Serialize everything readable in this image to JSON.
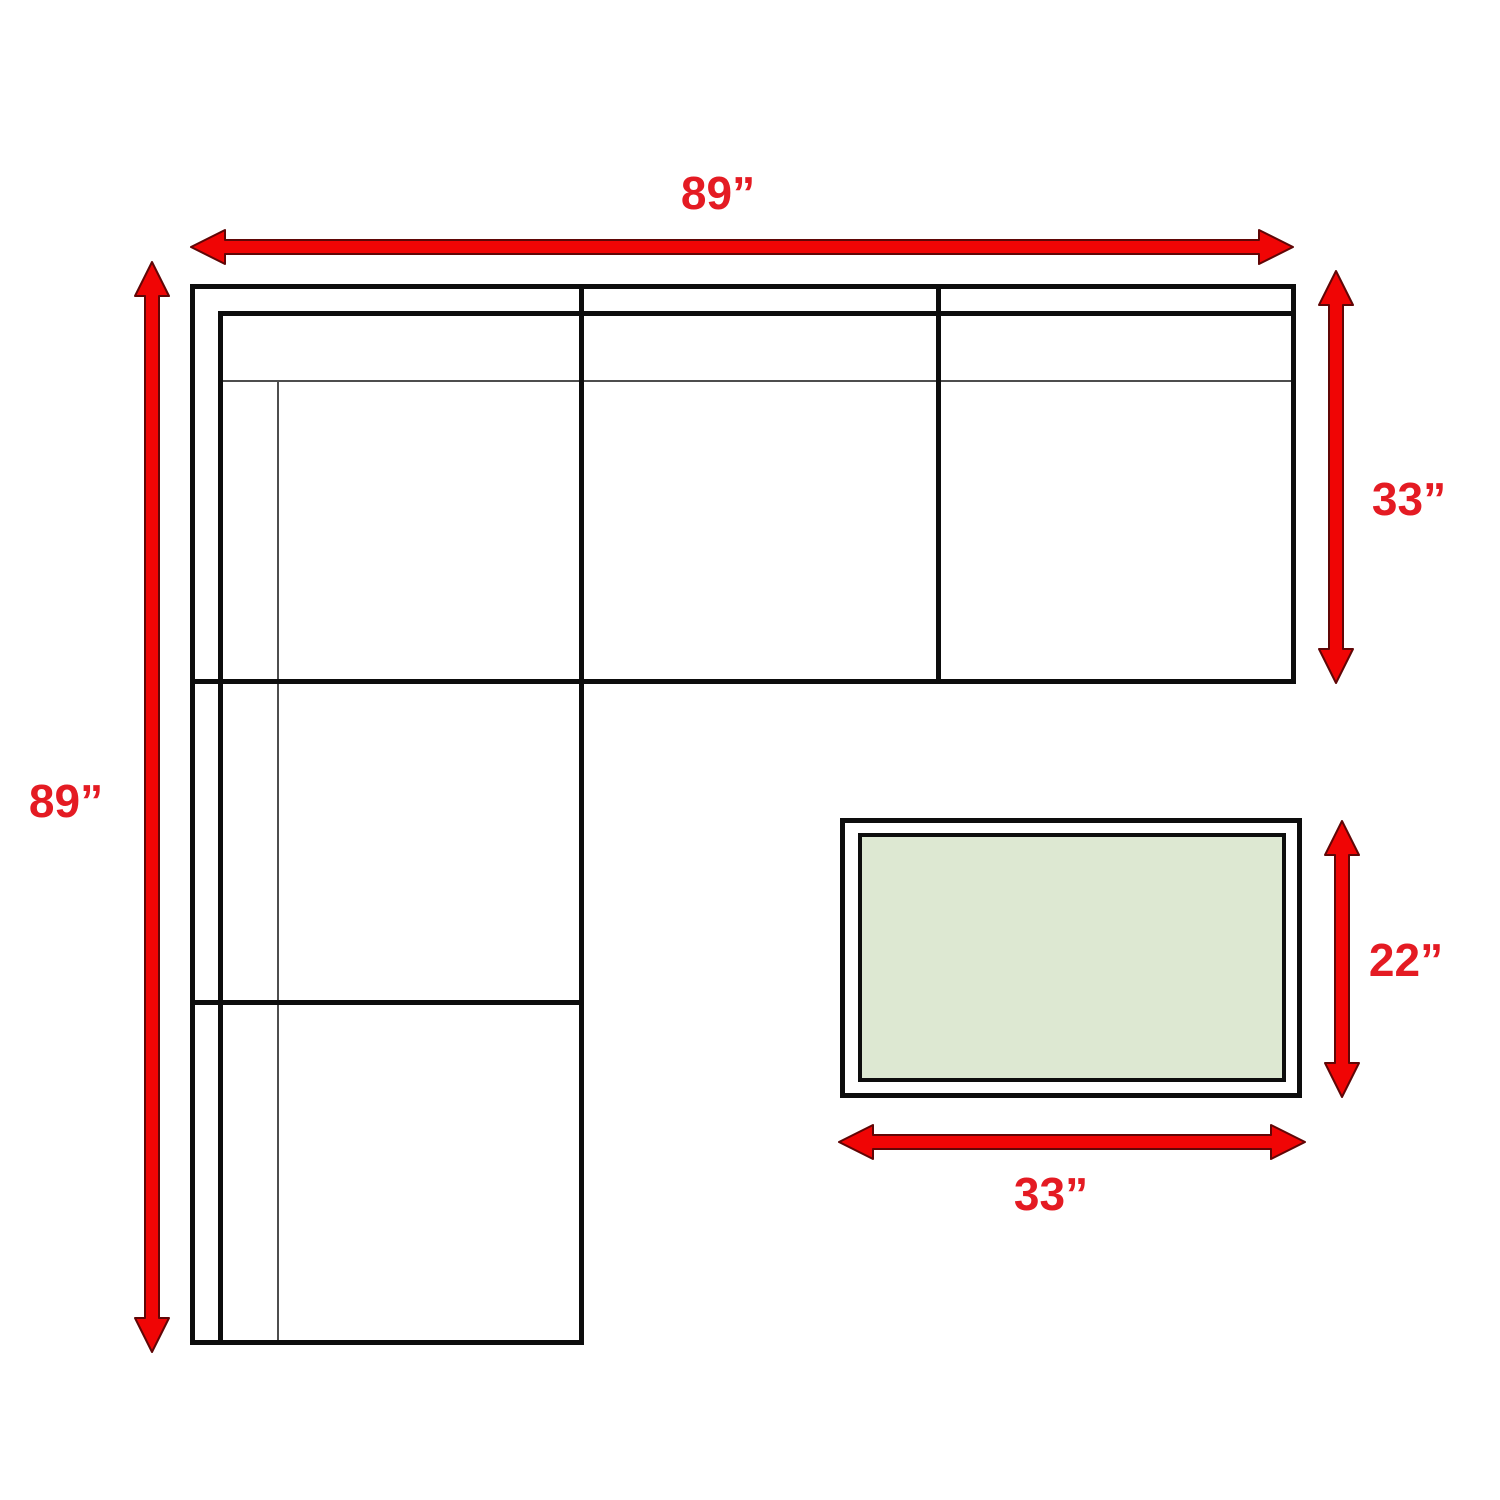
{
  "diagram": {
    "labels": {
      "sofa_width_top": "89”",
      "sofa_length_left": "89”",
      "sofa_depth_right": "33”",
      "table_depth_right": "22”",
      "table_width_bottom": "33”"
    },
    "colors": {
      "arrow_red": "#f00505",
      "arrow_outline_red": "#600606",
      "label_red": "#e41b23",
      "outline_black": "#0d0d0d",
      "table_fill_green": "#dde8d2"
    }
  }
}
